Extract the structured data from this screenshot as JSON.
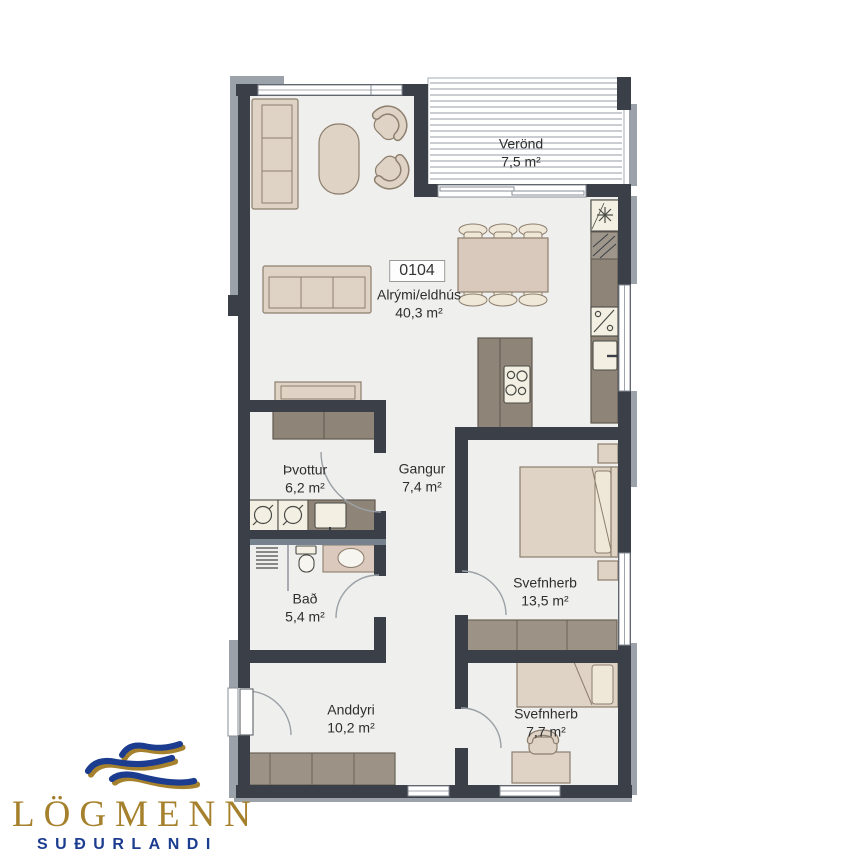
{
  "logo": {
    "title": "LÖGMENN",
    "subtitle": "SUÐURLANDI",
    "title_color": "#A6812D",
    "subtitle_color": "#1C3C90"
  },
  "plan": {
    "unit_label": "0104",
    "rooms": [
      {
        "name": "Verönd",
        "area": "7,5 m²"
      },
      {
        "name": "Alrými/eldhús",
        "area": "40,3 m²"
      },
      {
        "name": "Þvottur",
        "area": "6,2 m²"
      },
      {
        "name": "Gangur",
        "area": "7,4 m²"
      },
      {
        "name": "Bað",
        "area": "5,4 m²"
      },
      {
        "name": "Svefnherb",
        "area": "13,5 m²"
      },
      {
        "name": "Anddyri",
        "area": "10,2 m²"
      },
      {
        "name": "Svefnherb",
        "area": "7,7 m²"
      }
    ],
    "colors": {
      "wall": "#3B3F48",
      "exterior_band": "#9CA2A9",
      "floor": "#EFEFED",
      "furniture_beige": "#DFD3C6",
      "furniture_taupe": "#8E8578",
      "appliance_cream": "#F3F0E3",
      "logo_gold": "#A6812D",
      "logo_blue": "#1C3C90"
    }
  }
}
